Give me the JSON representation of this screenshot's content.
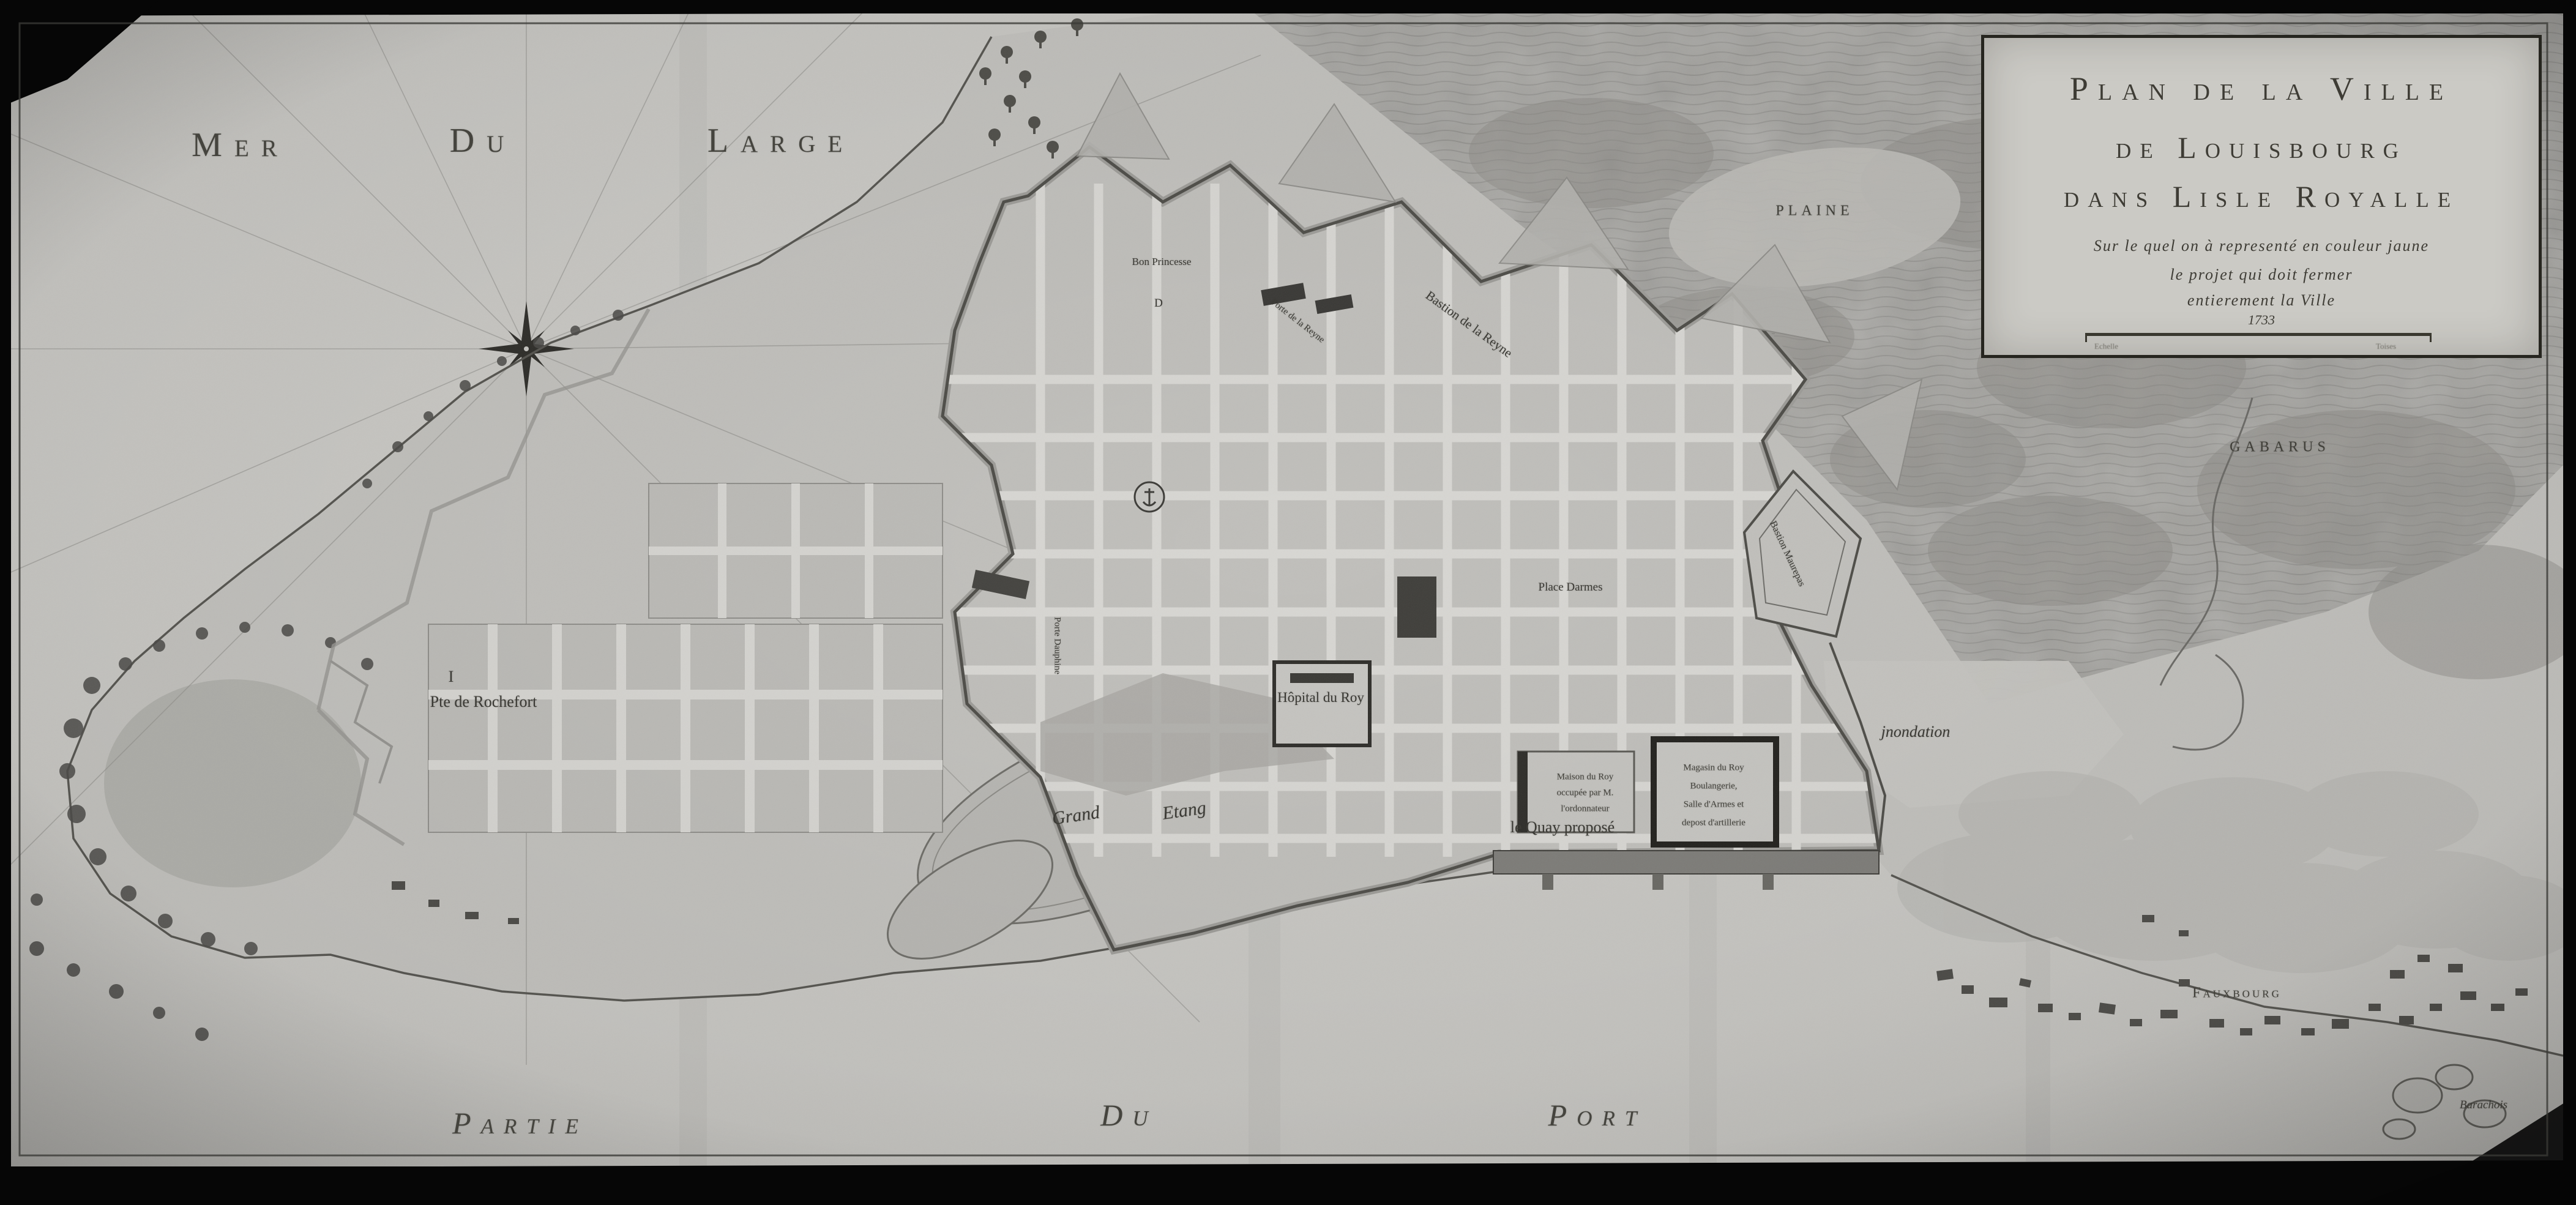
{
  "map_title": "Plan de la Ville de Louisbourg dans l'Isle Royalle",
  "sea_label": {
    "word1": "Mer",
    "word2": "Du",
    "word3": "Large"
  },
  "port_label": {
    "word1": "Partie",
    "word2": "Du",
    "word3": "Port"
  },
  "cartouche": {
    "title_line1": "Plan de la Ville",
    "title_line2": "de Louisbourg",
    "title_line3": "dans Lisle Royalle",
    "subtitle_line1": "Sur le quel on à representé en couleur jaune",
    "subtitle_line2": "le projet qui doit fermer",
    "subtitle_line3": "entierement la Ville",
    "date": "1733",
    "scale_caption_left": "Echelle",
    "scale_caption_right": "Toises"
  },
  "labels": {
    "bastion_princesse": "Bon Princesse",
    "porte_reyne": "Porte de la Reyne",
    "bastion_reyne": "Bastion de la Reyne",
    "bastion_maurepas": "Bastion Maurepas",
    "porte_dauphine": "Porte Dauphine",
    "hopital": "Hôpital du Roy",
    "place_darmes": "Place Darmes",
    "maison_roy_l1": "Maison du Roy",
    "maison_roy_l2": "occupée par M.",
    "maison_roy_l3": "l'ordonnateur",
    "magasins_l1": "Magasin du Roy",
    "magasins_l2": "Boulangerie,",
    "magasins_l3": "Salle d'Armes et",
    "magasins_l4": "depost d'artillerie",
    "inondation": "jnondation",
    "quay": "le Quay proposé",
    "grand_etang_1": "Grand",
    "grand_etang_2": "Etang",
    "rochefort": "Pte de Rochefort",
    "plaine": "PLAINE",
    "gabarus": "GABARUS",
    "fauxbourg": "Fauxbourg",
    "barachois": "Barachois",
    "marker_i": "I",
    "marker_d": "D"
  },
  "colors": {
    "paper": "#c6c5c1",
    "ink": "#3b3a35",
    "photo_border": "#060606"
  }
}
